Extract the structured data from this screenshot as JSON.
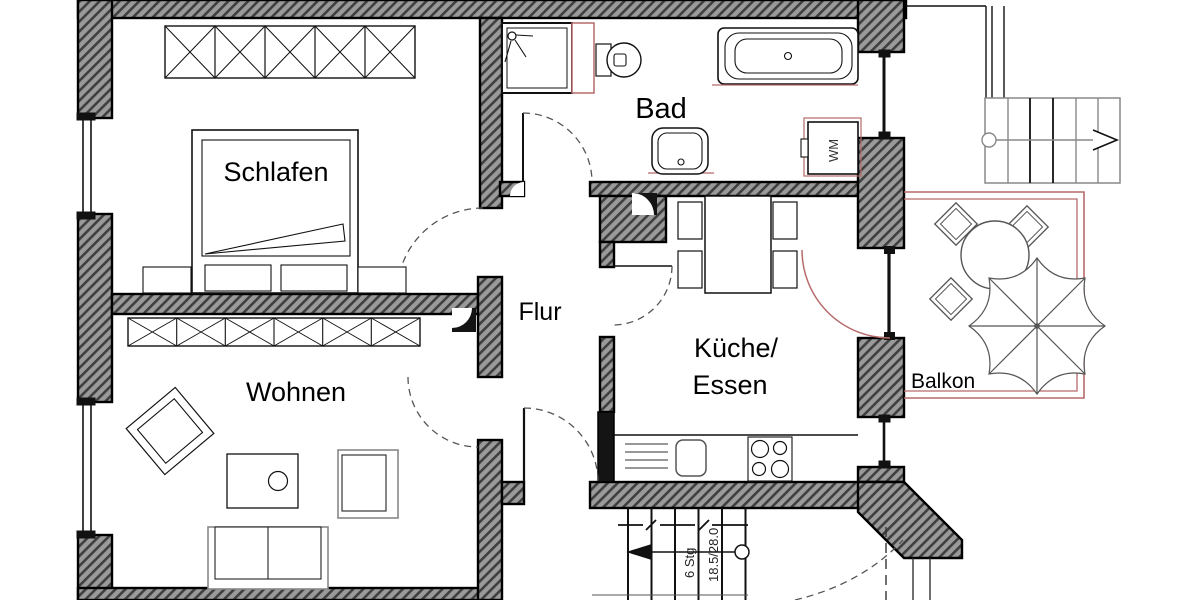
{
  "rooms": {
    "schlafen": {
      "label": "Schlafen"
    },
    "bad": {
      "label": "Bad"
    },
    "flur": {
      "label": "Flur"
    },
    "kueche": {
      "line1": "Küche/",
      "line2": "Essen"
    },
    "wohnen": {
      "label": "Wohnen"
    },
    "balkon": {
      "label": "Balkon"
    }
  },
  "stairs": {
    "steps_label": "6 Stg",
    "dimension_label": "18.5/28.0"
  },
  "appliances": {
    "washing_machine_label": "WM"
  },
  "colors": {
    "wall_hatch_dark": "#3f3f3f",
    "wall_hatch_light": "#9a9a9a",
    "wall_outline": "#000000",
    "accent_red": "#b66a6a",
    "line": "#111111",
    "furniture_gray": "#888888"
  }
}
